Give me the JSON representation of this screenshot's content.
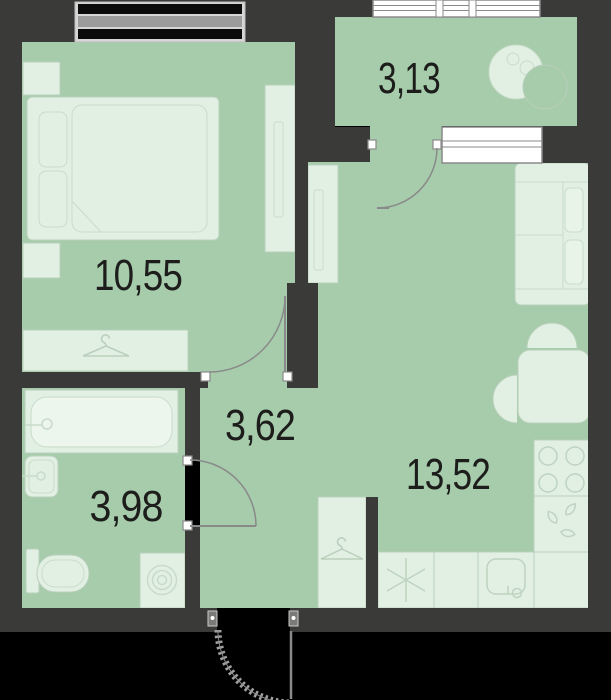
{
  "floor_plan": {
    "rooms": [
      {
        "id": "bedroom",
        "area": "10,55"
      },
      {
        "id": "loggia",
        "area": "3,13"
      },
      {
        "id": "hallway",
        "area": "3,62"
      },
      {
        "id": "bathroom",
        "area": "3,98"
      },
      {
        "id": "kitchen-living",
        "area": "13,52"
      }
    ],
    "colors": {
      "walls": "#3a3a38",
      "floor": "#a6ccab",
      "furniture_fill": "#e2f0e3",
      "furniture_stroke": "#b9cfbb",
      "detail_stroke": "#c8dbc9",
      "door_stroke": "#8a8a8a",
      "window_white": "#ffffff",
      "window_dark_band": "#0b0b0b",
      "window_gray_band": "#9c9c9c",
      "label_text": "#1d1d1b",
      "outside": "#000000"
    },
    "icons": [
      "hanger-icon",
      "spiral-icon",
      "burner-icon",
      "asterisk-icon",
      "teardrop-icon",
      "door-swing-arc",
      "tv-icon",
      "hanger-hook"
    ]
  }
}
